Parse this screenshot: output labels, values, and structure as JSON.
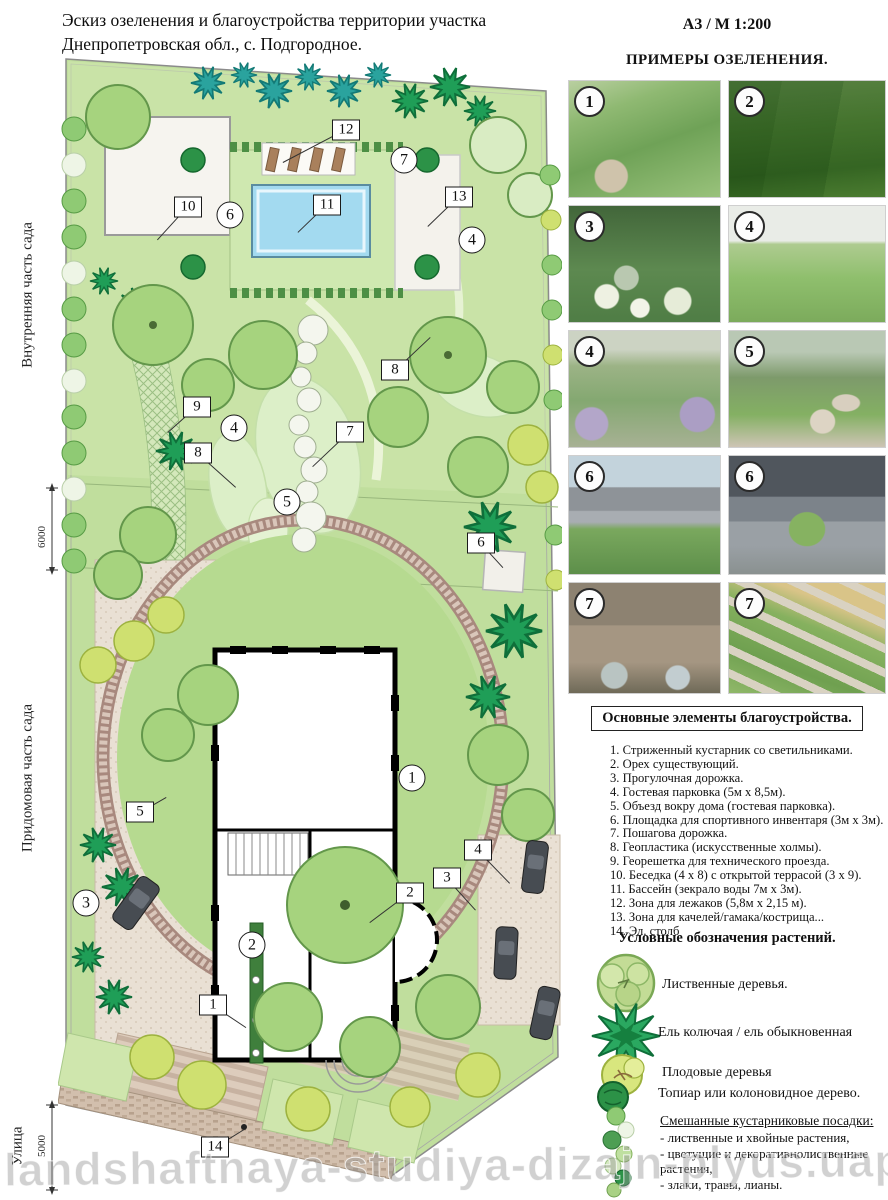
{
  "title": {
    "line1": "Эскиз озеленения и благоустройства территории участка",
    "line2": "Днепропетровская обл., с. Подгородное."
  },
  "header": {
    "sheet_format": "А3 / М 1:200",
    "examples_title": "ПРИМЕРЫ ОЗЕЛЕНЕНИЯ."
  },
  "examples": {
    "photos": [
      {
        "badge": "1",
        "subject": "сад с газоном и гравийной дорожкой"
      },
      {
        "badge": "2",
        "subject": "стриженые живые изгороди"
      },
      {
        "badge": "3",
        "subject": "миксбордер с гортензиями"
      },
      {
        "badge": "4",
        "subject": "геопластика — газонные холмы с деревьями"
      },
      {
        "badge": "4",
        "subject": "террасированный газон"
      },
      {
        "badge": "5",
        "subject": "пошаговая дорожка из плит"
      },
      {
        "badge": "6",
        "subject": "беседка с бассейном"
      },
      {
        "badge": "6",
        "subject": "открытая терраса у бассейна"
      },
      {
        "badge": "7",
        "subject": "рокарий у каменной стены"
      },
      {
        "badge": "7",
        "subject": "пошаговые плиты в газоне со злаками"
      }
    ]
  },
  "elements_list": {
    "heading": "Основные элементы благоустройства.",
    "items": [
      "1. Стриженный кустарник со светильниками.",
      "2. Орех существующий.",
      "3. Прогулочная дорожка.",
      "4. Гостевая парковка (5м х 8,5м).",
      "5. Объезд вокру дома (гостевая парковка).",
      "6. Площадка для спортивного инвентаря (3м х  3м).",
      "7. Пошагова дорожка.",
      "8. Геопластика (искусственные холмы).",
      "9. Георешетка для технического проезда.",
      "10. Беседка (4 х 8) с открытой террасой (3 х 9).",
      "11. Бассейн (зекрало воды 7м х 3м).",
      "12. Зона для лежаков (5,8м х 2,15 м).",
      "13. Зона для качелей/гамака/кострища...",
      "14. Эл. столб"
    ]
  },
  "plants_legend": {
    "heading": "Условные обозначения растений.",
    "entries": [
      {
        "icon": "deciduous-tree-icon",
        "label": "Лиственные деревья."
      },
      {
        "icon": "spruce-icon",
        "label": "Ель колючая / ель обыкновенная"
      },
      {
        "icon": "fruit-tree-icon",
        "label": "Плодовые деревья"
      },
      {
        "icon": "topiary-icon",
        "label": "Топиар или колоновидное дерево."
      }
    ],
    "mixed": {
      "heading": "Смешанные кустарниковые посадки:",
      "items": [
        "- лиственные и хвойные растения,",
        "- цветущие и декоративнолиственные растения,",
        "- злаки, травы, лианы."
      ]
    }
  },
  "plan": {
    "side_labels": [
      {
        "label": "Внутренняя часть сада"
      },
      {
        "label": "Придомовая часть сада"
      },
      {
        "label": "Улица"
      }
    ],
    "dimensions": [
      {
        "value": "6000"
      },
      {
        "value": "5000"
      }
    ],
    "callouts_square": [
      {
        "n": "12",
        "x": 288,
        "y": 75,
        "tx": 225,
        "ty": 108
      },
      {
        "n": "10",
        "x": 130,
        "y": 152,
        "tx": 100,
        "ty": 185
      },
      {
        "n": "11",
        "x": 269,
        "y": 150,
        "tx": 240,
        "ty": 178
      },
      {
        "n": "13",
        "x": 401,
        "y": 142,
        "tx": 370,
        "ty": 172
      },
      {
        "n": "8",
        "x": 337,
        "y": 315,
        "tx": 372,
        "ty": 282
      },
      {
        "n": "9",
        "x": 139,
        "y": 352,
        "tx": 110,
        "ty": 378
      },
      {
        "n": "8",
        "x": 140,
        "y": 398,
        "tx": 178,
        "ty": 432
      },
      {
        "n": "7",
        "x": 292,
        "y": 377,
        "tx": 255,
        "ty": 412
      },
      {
        "n": "6",
        "x": 423,
        "y": 488,
        "tx": 445,
        "ty": 512
      },
      {
        "n": "5",
        "x": 82,
        "y": 757,
        "tx": 108,
        "ty": 742
      },
      {
        "n": "2",
        "x": 352,
        "y": 838,
        "tx": 312,
        "ty": 868
      },
      {
        "n": "3",
        "x": 389,
        "y": 823,
        "tx": 418,
        "ty": 855
      },
      {
        "n": "4",
        "x": 420,
        "y": 795,
        "tx": 452,
        "ty": 828
      },
      {
        "n": "1",
        "x": 155,
        "y": 950,
        "tx": 188,
        "ty": 972
      },
      {
        "n": "14",
        "x": 157,
        "y": 1092,
        "tx": 186,
        "ty": 1074
      }
    ],
    "callouts_circle": [
      {
        "n": "7",
        "x": 346,
        "y": 105
      },
      {
        "n": "6",
        "x": 172,
        "y": 160
      },
      {
        "n": "4",
        "x": 414,
        "y": 185
      },
      {
        "n": "4",
        "x": 176,
        "y": 373
      },
      {
        "n": "5",
        "x": 229,
        "y": 447
      },
      {
        "n": "1",
        "x": 354,
        "y": 723
      },
      {
        "n": "3",
        "x": 28,
        "y": 848
      },
      {
        "n": "2",
        "x": 194,
        "y": 890
      }
    ]
  },
  "watermark": {
    "text": "landshaftnaya-studiya-dizajn-plyus.uapro..."
  },
  "colors": {
    "lawn": "#c0de9d",
    "pool": "#a3daf0",
    "brick_ring": "#a8897e",
    "spruce": "#1f9e57",
    "teal_spruce": "#2aa39e",
    "paving": "#e9e0d4"
  }
}
